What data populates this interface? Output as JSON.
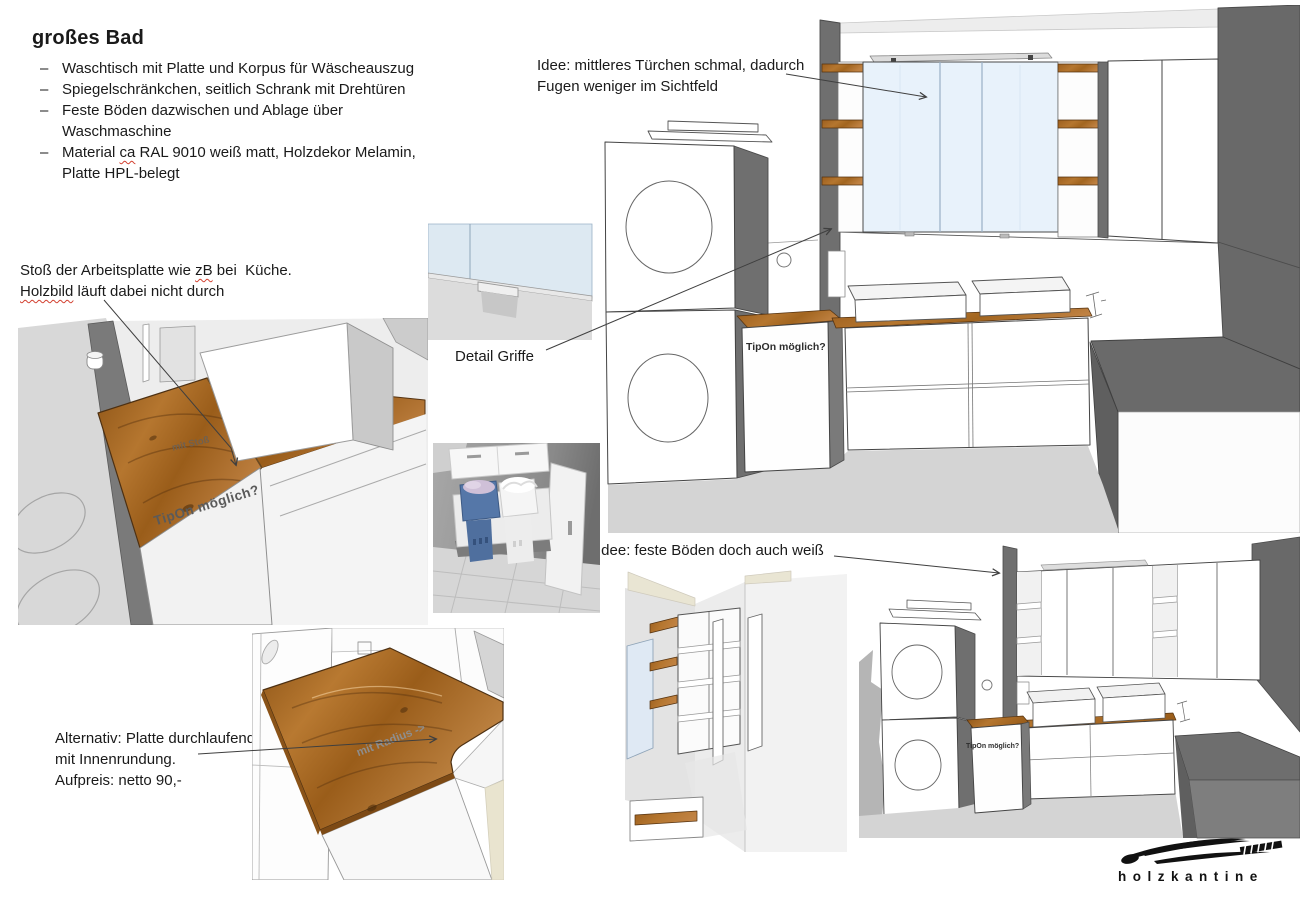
{
  "slide": {
    "title": "großes Bad",
    "bullet_marker": "–",
    "bullets": {
      "b1": "Waschtisch mit Platte und Korpus für Wäscheauszug",
      "b2": "Spiegelschränkchen, seitlich Schrank mit Drehtüren",
      "b3": "Feste Böden dazwischen und Ablage über\nWaschmaschine",
      "b4_pre": "Material ",
      "b4_mark": "ca",
      "b4_post": " RAL 9010 weiß matt, Holzdekor Melamin,\nPlatte HPL-belegt"
    },
    "notes": {
      "stoss_pre": "Stoß der Arbeitsplatte wie ",
      "stoss_mark": "zB",
      "stoss_post": " bei  Küche.",
      "stoss_line2_mark": "Holzbild",
      "stoss_line2_post": " läuft dabei nicht durch",
      "idee_tuerchen": "Idee: mittleres Türchen schmal, dadurch\nFugen weniger im Sichtfeld",
      "detail_griffe": "Detail Griffe",
      "idee_boeden": "Idee: feste Böden doch auch weiß",
      "alternativ": "Alternativ: Platte durchlaufend\nmit Innenrundung.\nAufpreis: netto 90,-"
    },
    "scene_labels": {
      "tipon_main": "TipOn möglich?",
      "tipon_small": "TipOn möglich?",
      "tipon_closeup": "TipOn möglich?",
      "mit_stoss": "mit Stoß",
      "mit_radius": "mit Radius ->"
    },
    "logo": {
      "text": "holzkantine"
    },
    "colors": {
      "wood": "#a96a22",
      "mirror_blue": "#e8f2fb",
      "wall_dark_gray": "#6f6f6f",
      "floor_gray": "#d4d4d4",
      "ceiling_cream": "#e9e5d3",
      "spellcheck_red": "#d23f2f",
      "laundry_basket_blue": "#5577a8"
    }
  }
}
